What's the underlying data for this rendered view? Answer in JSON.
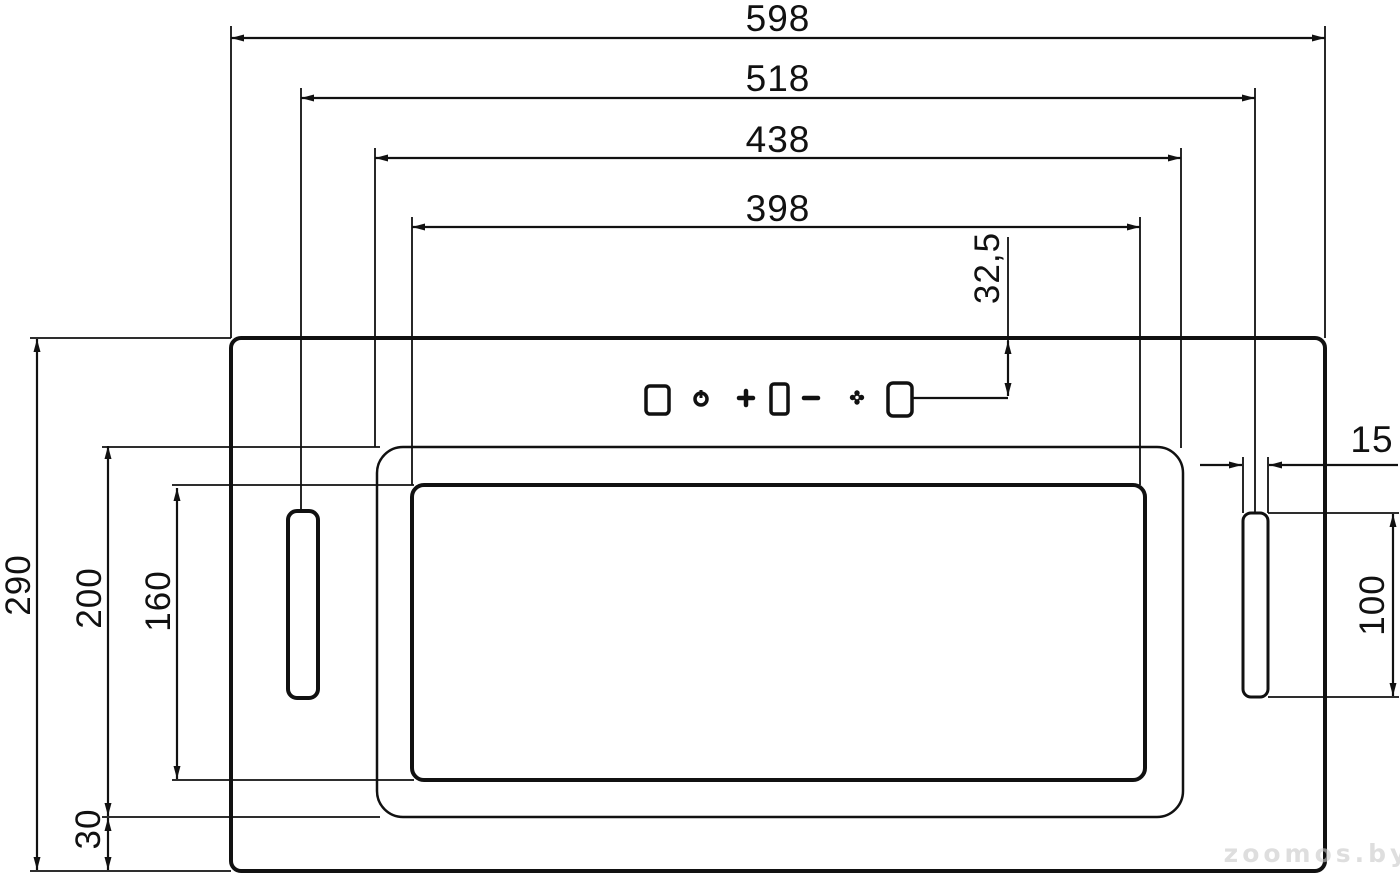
{
  "drawing": {
    "subject": "cooker-hood-bottom-view-dimension-drawing",
    "dims": {
      "overall_width": {
        "label": "598"
      },
      "slot_span": {
        "label": "518"
      },
      "recess_width": {
        "label": "438"
      },
      "panel_width": {
        "label": "398"
      },
      "control_offset": {
        "label": "32,5"
      },
      "slot_width": {
        "label": "15"
      },
      "slot_height": {
        "label": "100"
      },
      "overall_depth": {
        "label": "290"
      },
      "recess_depth": {
        "label": "200"
      },
      "panel_depth": {
        "label": "160"
      },
      "rear_offset": {
        "label": "30"
      }
    },
    "controls": {
      "icons": [
        "square-button",
        "power",
        "plus",
        "display-window",
        "minus",
        "light",
        "square-button"
      ]
    },
    "watermark": {
      "text": "zoomos.by"
    },
    "colors": {
      "line": "#111111",
      "background": "#ffffff",
      "watermark": "#c9c9c9"
    }
  }
}
